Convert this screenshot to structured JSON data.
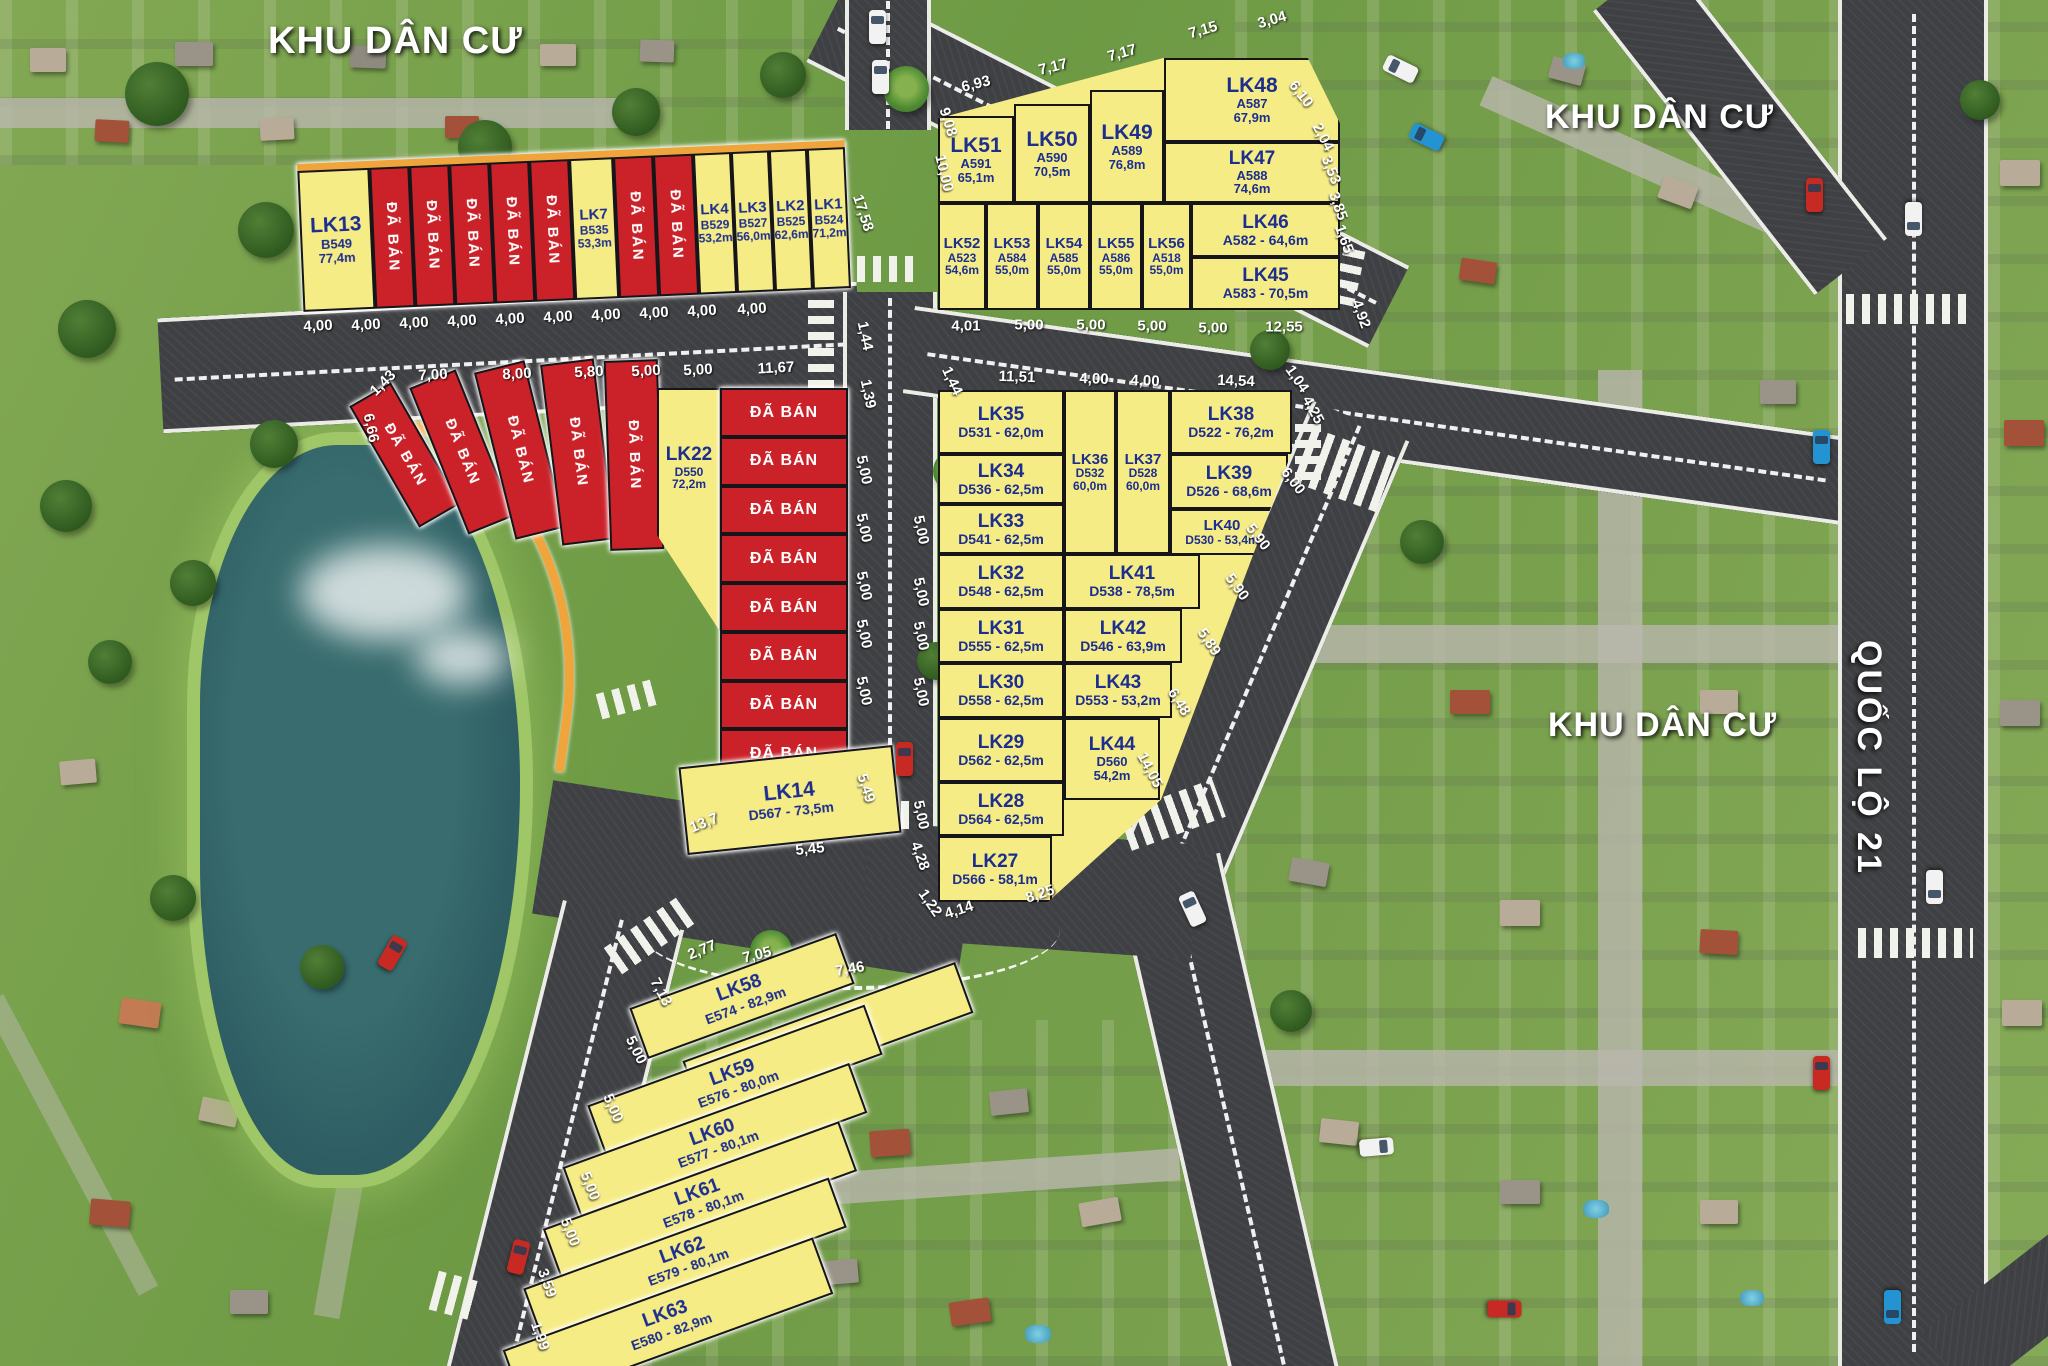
{
  "titles": {
    "residential_area_1": "KHU DÂN CƯ",
    "residential_area_2": "KHU DÂN CƯ",
    "residential_area_3": "KHU DÂN CƯ",
    "highway": "QUỐC LỘ 21",
    "sold": "ĐÃ BÁN"
  },
  "colors": {
    "available_plot": "#f6ec86",
    "sold_plot": "#cb2229",
    "plot_text": "#1c2e8e",
    "road": "#3f4043",
    "boundary": "#efa43c",
    "road_text": "#ffffff"
  },
  "blocks": {
    "b": {
      "lk13": {
        "id": "LK13",
        "code": "B549",
        "area": "77,4m"
      },
      "lk7": {
        "id": "LK7",
        "code": "B535",
        "area": "53,3m"
      },
      "lk4": {
        "id": "LK4",
        "code": "B529",
        "area": "53,2m"
      },
      "lk3": {
        "id": "LK3",
        "code": "B527",
        "area": "56,0m"
      },
      "lk2": {
        "id": "LK2",
        "code": "B525",
        "area": "62,6m"
      },
      "lk1": {
        "id": "LK1",
        "code": "B524",
        "area": "71,2m"
      }
    },
    "a": {
      "lk51": {
        "id": "LK51",
        "code": "A591",
        "area": "65,1m"
      },
      "lk50": {
        "id": "LK50",
        "code": "A590",
        "area": "70,5m"
      },
      "lk49": {
        "id": "LK49",
        "code": "A589",
        "area": "76,8m"
      },
      "lk48": {
        "id": "LK48",
        "code": "A587",
        "area": "67,9m"
      },
      "lk47": {
        "id": "LK47",
        "code": "A588",
        "area": "74,6m"
      },
      "lk52": {
        "id": "LK52",
        "code": "A523",
        "area": "54,6m"
      },
      "lk53": {
        "id": "LK53",
        "code": "A584",
        "area": "55,0m"
      },
      "lk54": {
        "id": "LK54",
        "code": "A585",
        "area": "55,0m"
      },
      "lk55": {
        "id": "LK55",
        "code": "A586",
        "area": "55,0m"
      },
      "lk56": {
        "id": "LK56",
        "code": "A518",
        "area": "55,0m"
      },
      "lk46": {
        "id": "LK46",
        "info": "A582 - 64,6m"
      },
      "lk45": {
        "id": "LK45",
        "info": "A583 - 70,5m"
      }
    },
    "c": {
      "lk22": {
        "id": "LK22",
        "code": "D550",
        "area": "72,2m"
      },
      "lk14": {
        "id": "LK14",
        "info": "D567 - 73,5m"
      }
    },
    "d": {
      "lk35": {
        "id": "LK35",
        "info": "D531 - 62,0m"
      },
      "lk34": {
        "id": "LK34",
        "info": "D536 - 62,5m"
      },
      "lk33": {
        "id": "LK33",
        "info": "D541 - 62,5m"
      },
      "lk32": {
        "id": "LK32",
        "info": "D548 - 62,5m"
      },
      "lk31": {
        "id": "LK31",
        "info": "D555 - 62,5m"
      },
      "lk30": {
        "id": "LK30",
        "info": "D558 - 62,5m"
      },
      "lk29": {
        "id": "LK29",
        "info": "D562 - 62,5m"
      },
      "lk28": {
        "id": "LK28",
        "info": "D564 - 62,5m"
      },
      "lk27": {
        "id": "LK27",
        "info": "D566 - 58,1m"
      },
      "lk36": {
        "id": "LK36",
        "code": "D532",
        "area": "60,0m"
      },
      "lk37": {
        "id": "LK37",
        "code": "D528",
        "area": "60,0m"
      },
      "lk38": {
        "id": "LK38",
        "info": "D522 - 76,2m"
      },
      "lk39": {
        "id": "LK39",
        "info": "D526 - 68,6m"
      },
      "lk40": {
        "id": "LK40",
        "info": "D530 - 53,4m"
      },
      "lk41": {
        "id": "LK41",
        "info": "D538 - 78,5m"
      },
      "lk42": {
        "id": "LK42",
        "info": "D546 - 63,9m"
      },
      "lk43": {
        "id": "LK43",
        "info": "D553 - 53,2m"
      },
      "lk44": {
        "id": "LK44",
        "code": "D560",
        "area": "54,2m"
      }
    },
    "e": {
      "lk58": {
        "id": "LK58",
        "info": "E574 - 82,9m"
      },
      "lk57": {
        "id": "LK57",
        "info": "E575 - 84,6m"
      },
      "lk59": {
        "id": "LK59",
        "info": "E576 - 80,0m"
      },
      "lk60": {
        "id": "LK60",
        "info": "E577 - 80,1m"
      },
      "lk61": {
        "id": "LK61",
        "info": "E578 - 80,1m"
      },
      "lk62": {
        "id": "LK62",
        "info": "E579 - 80,1m"
      },
      "lk63": {
        "id": "LK63",
        "info": "E580 - 82,9m"
      }
    }
  },
  "dims": {
    "road_a_top": [
      "4,00",
      "4,00",
      "4,00",
      "4,00",
      "4,00",
      "4,00",
      "4,00",
      "4,00",
      "4,00",
      "4,00"
    ],
    "road_a_bottom": [
      "1,43",
      "7,00",
      "8,00",
      "5,80",
      "5,00",
      "5,00",
      "11,67"
    ],
    "road_a_left": "6,66",
    "v_road": [
      "17,58",
      "1,44",
      "1,39",
      "1,44"
    ],
    "a_top": [
      "6,93",
      "7,17",
      "7,17",
      "7,15",
      "3,04"
    ],
    "a_left": [
      "9,08",
      "10,00"
    ],
    "a_right": [
      "6,10",
      "2,04",
      "3,53",
      "3,85",
      "1,65",
      "4,92"
    ],
    "a_bottom": [
      "4,01",
      "5,00",
      "5,00",
      "5,00",
      "5,00",
      "12,55"
    ],
    "d_top": [
      "11,51",
      "4,00",
      "4,00",
      "14,54"
    ],
    "d_top_right": [
      "1,04",
      "4,25"
    ],
    "road_e": [
      "6,00",
      "5,90",
      "5,90",
      "5,89",
      "6,48",
      "14,05"
    ],
    "road_b_left": [
      "5,00",
      "5,00",
      "5,00",
      "5,00",
      "5,00",
      "5,49"
    ],
    "road_b_right": [
      "5,00",
      "5,00",
      "5,00",
      "5,00",
      "5,00"
    ],
    "d_bottom": [
      "4,28",
      "1,22",
      "4,14",
      "8,25"
    ],
    "road_f": [
      "13,7",
      "5,45",
      "2,77",
      "7,05",
      "7,46"
    ],
    "road_g": [
      "7,13",
      "5,00",
      "5,00",
      "5,00",
      "5,00",
      "3,59",
      "1,99"
    ]
  }
}
